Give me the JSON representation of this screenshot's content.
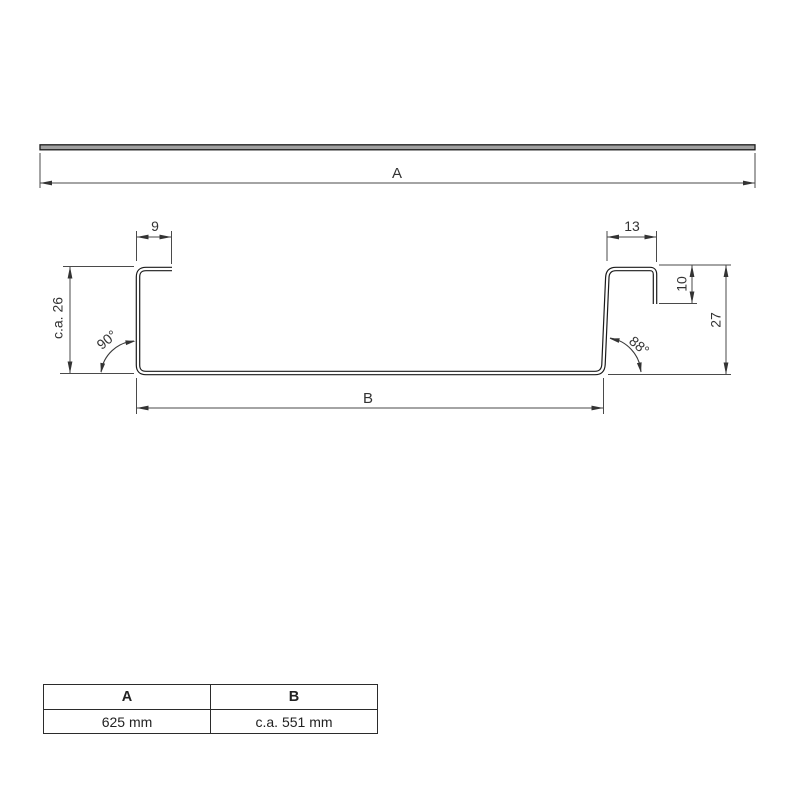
{
  "flat_profile": {
    "width_label": "A"
  },
  "cross_section": {
    "left_flange_width": "9",
    "right_flange_width": "13",
    "right_lip_height": "10",
    "left_height": "c.a. 26",
    "right_height": "27",
    "left_angle": "90°",
    "right_angle": "88°",
    "base_width_label": "B"
  },
  "dimensions_table": {
    "headers": [
      "A",
      "B"
    ],
    "values": [
      "625 mm",
      "c.a. 551 mm"
    ]
  },
  "colors": {
    "dimension_line": "#4a4a4a",
    "text": "#333333",
    "profile_stroke": "#1b1b1b",
    "sheet_fill": "#a0a0a0",
    "background": "#ffffff"
  }
}
